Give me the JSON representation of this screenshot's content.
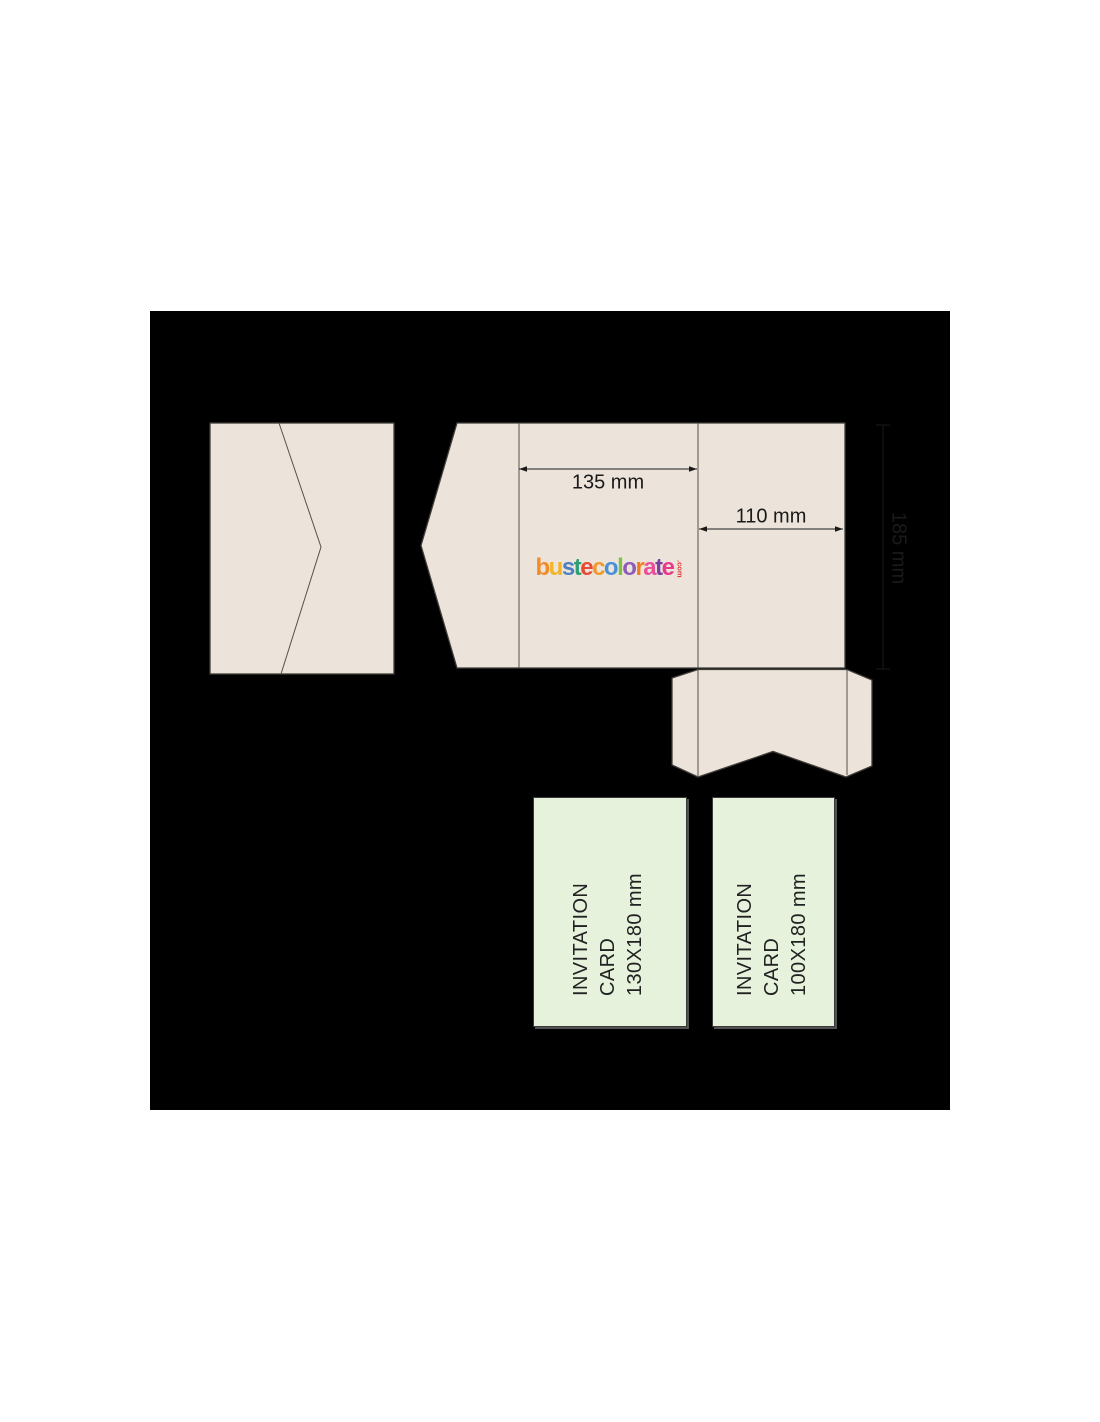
{
  "colors": {
    "page-bg": "#ffffff",
    "panel-bg": "#000000",
    "envelope-fill": "#ece4db",
    "card-fill": "#e7f2dc",
    "outline": "#3f3c38",
    "dim-line": "#1a1a1a",
    "text": "#1a1a1a"
  },
  "dimensions": {
    "main_width": "135 mm",
    "right_width": "110 mm",
    "height": "185 mm"
  },
  "logo": {
    "text": "bustecolorate",
    "tld": ".com",
    "tld_color": "#e03a3a",
    "letters": [
      {
        "ch": "b",
        "color": "#f28c28"
      },
      {
        "ch": "u",
        "color": "#f2b52a"
      },
      {
        "ch": "s",
        "color": "#4a7fc1"
      },
      {
        "ch": "t",
        "color": "#2f9e74"
      },
      {
        "ch": "e",
        "color": "#e84a33"
      },
      {
        "ch": "c",
        "color": "#f2992e"
      },
      {
        "ch": "o",
        "color": "#4a90d9"
      },
      {
        "ch": "l",
        "color": "#7cc243"
      },
      {
        "ch": "o",
        "color": "#8f5cb8"
      },
      {
        "ch": "r",
        "color": "#f27d21"
      },
      {
        "ch": "a",
        "color": "#ea4f9b"
      },
      {
        "ch": "t",
        "color": "#7d3f9e"
      },
      {
        "ch": "e",
        "color": "#e8388a"
      }
    ]
  },
  "cards": [
    {
      "lines": [
        "INVITATION",
        "CARD",
        "130X180 mm"
      ]
    },
    {
      "lines": [
        "INVITATION",
        "CARD",
        "100X180 mm"
      ]
    }
  ]
}
